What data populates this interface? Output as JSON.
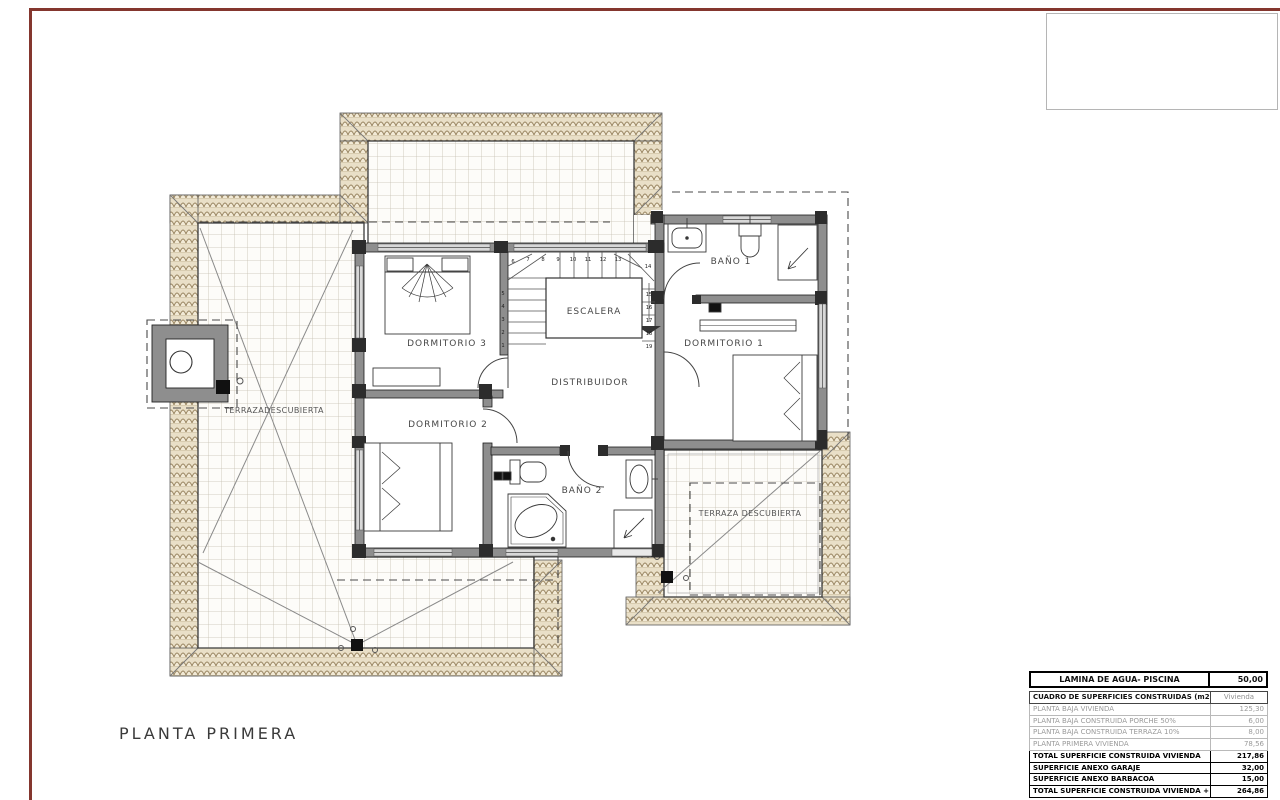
{
  "page": {
    "title": "PLANTA PRIMERA",
    "frame_color": "#84362e",
    "roof_tile_color": "#e9dfc7",
    "wall_color": "#8e8e8e"
  },
  "plan": {
    "rooms": {
      "dormitorio3": "DORMITORIO 3",
      "dormitorio2": "DORMITORIO 2",
      "dormitorio1": "DORMITORIO 1",
      "escalera": "ESCALERA",
      "distribuidor": "DISTRIBUIDOR",
      "bano1": "BAÑO 1",
      "bano2": "BAÑO 2",
      "terraza_izquierda": "TERRAZADESCUBIERTA",
      "terraza_derecha": "TERRAZA DESCUBIERTA"
    },
    "stair_numbers": [
      "1",
      "2",
      "3",
      "4",
      "5",
      "6",
      "7",
      "8",
      "9",
      "10",
      "11",
      "12",
      "13",
      "14",
      "15",
      "16",
      "17",
      "18",
      "19"
    ]
  },
  "tables": {
    "agua": {
      "label": "LAMINA DE AGUA- PISCINA",
      "value": "50,00"
    },
    "superficies": {
      "header": {
        "label": "CUADRO DE SUPERFICIES CONSTRUIDAS (m2)",
        "value": "Vivienda"
      },
      "rows": [
        {
          "label": "PLANTA BAJA VIVIENDA",
          "value": "125,30",
          "style": "light"
        },
        {
          "label": "PLANTA BAJA CONSTRUIDA PORCHE 50%",
          "value": "6,00",
          "style": "light"
        },
        {
          "label": "PLANTA BAJA CONSTRUIDA TERRAZA 10%",
          "value": "8,00",
          "style": "light"
        },
        {
          "label": "PLANTA PRIMERA VIVIENDA",
          "value": "78,56",
          "style": "light"
        },
        {
          "label": "TOTAL SUPERFICIE CONSTRUIDA VIVIENDA",
          "value": "217,86",
          "style": "total"
        },
        {
          "label": "SUPERFICIE ANEXO GARAJE",
          "value": "32,00",
          "style": "total"
        },
        {
          "label": "SUPERFICIE ANEXO BARBACOA",
          "value": "15,00",
          "style": "total"
        },
        {
          "label": "TOTAL SUPERFICIE CONSTRUIDA VIVIENDA + ANEXOS",
          "value": "264,86",
          "style": "total"
        }
      ]
    }
  }
}
